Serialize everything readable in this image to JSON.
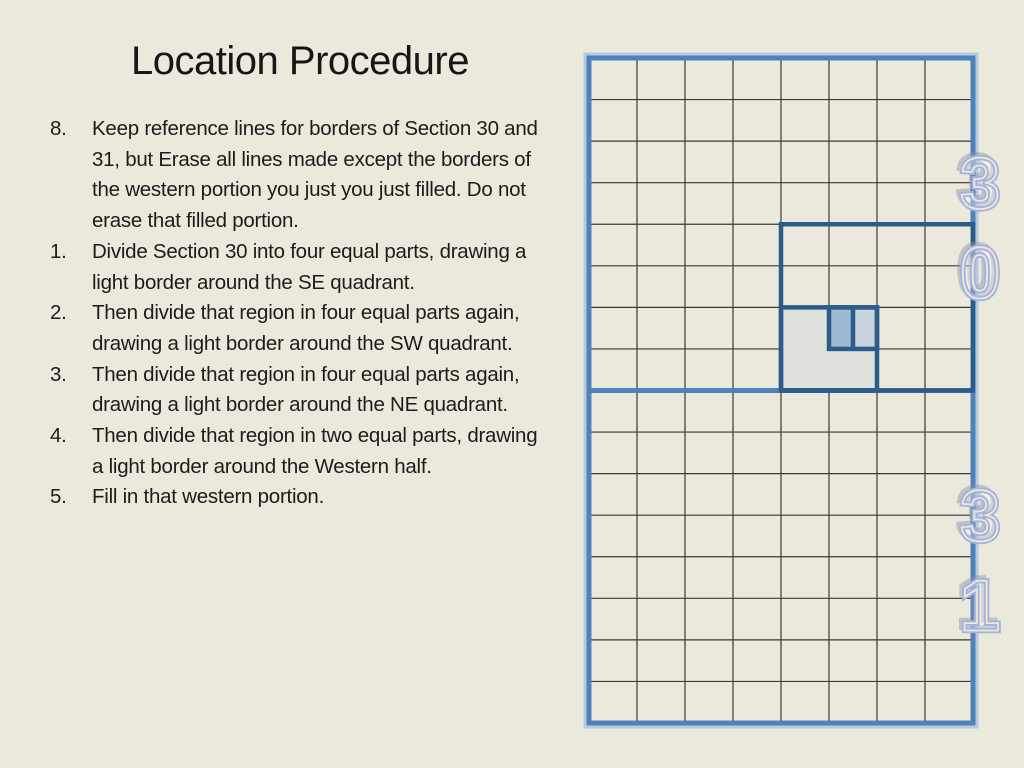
{
  "slide": {
    "background_color": "#ebe8dc",
    "text_color": "#1c1c1c",
    "title": "Location Procedure",
    "steps": [
      {
        "number": "8.",
        "text": "Keep reference lines for borders of Section 30 and 31, but Erase all lines made except the borders of the western portion you just you just filled. Do not erase that filled portion."
      },
      {
        "number": "1.",
        "text": "Divide Section 30 into four equal parts, drawing a light border around the SE quadrant."
      },
      {
        "number": "2.",
        "text": "Then divide that region in four equal parts again, drawing a light border around the SW quadrant."
      },
      {
        "number": "3.",
        "text": "Then divide that region in four equal parts again, drawing a light border around the NE quadrant."
      },
      {
        "number": "4.",
        "text": "Then divide that region in two equal parts, drawing a light border around the Western half."
      },
      {
        "number": "5.",
        "text": "Fill in that western portion."
      }
    ]
  },
  "diagram": {
    "sections": [
      {
        "name": "section-30",
        "label_digits": [
          "3",
          "0"
        ]
      },
      {
        "name": "section-31",
        "label_digits": [
          "3",
          "1"
        ]
      }
    ],
    "grid": {
      "cols": 8,
      "rows_per_section": 8
    },
    "colors": {
      "grid_line": "#3b3a34",
      "section_border": "#4f81bd",
      "section_border_halo": "#a9c2de",
      "heavy_border": "#2b5c8c",
      "fill_quadrant_light": "#dfe2da",
      "fill_west_half": "#9fb8d4",
      "fill_east_half": "#c8d2da",
      "digit_outline": "#a4b2de",
      "digit_shadow": "#8d93a3",
      "digit_inner": "#ebe8dc"
    },
    "overlays": {
      "fills": [
        {
          "name": "sw-box-fill",
          "x": 4,
          "y": 6,
          "w": 2,
          "h": 2,
          "color": "fill_quadrant_light"
        },
        {
          "name": "western-half-fill",
          "x": 5,
          "y": 6,
          "w": 0.5,
          "h": 1,
          "color": "fill_west_half"
        },
        {
          "name": "eastern-half-fill",
          "x": 5.5,
          "y": 6,
          "w": 0.5,
          "h": 1,
          "color": "fill_east_half"
        }
      ],
      "heavy_rects": [
        {
          "name": "se-quadrant-border",
          "x": 4,
          "y": 4,
          "w": 4,
          "h": 4
        },
        {
          "name": "sw-quadrant-border",
          "x": 4,
          "y": 6,
          "w": 2,
          "h": 2
        },
        {
          "name": "ne-quadrant-border",
          "x": 5,
          "y": 6,
          "w": 1,
          "h": 1
        }
      ],
      "heavy_lines": [
        {
          "name": "western-half-divider",
          "x1": 5.5,
          "y1": 6,
          "x2": 5.5,
          "y2": 7
        }
      ]
    }
  }
}
